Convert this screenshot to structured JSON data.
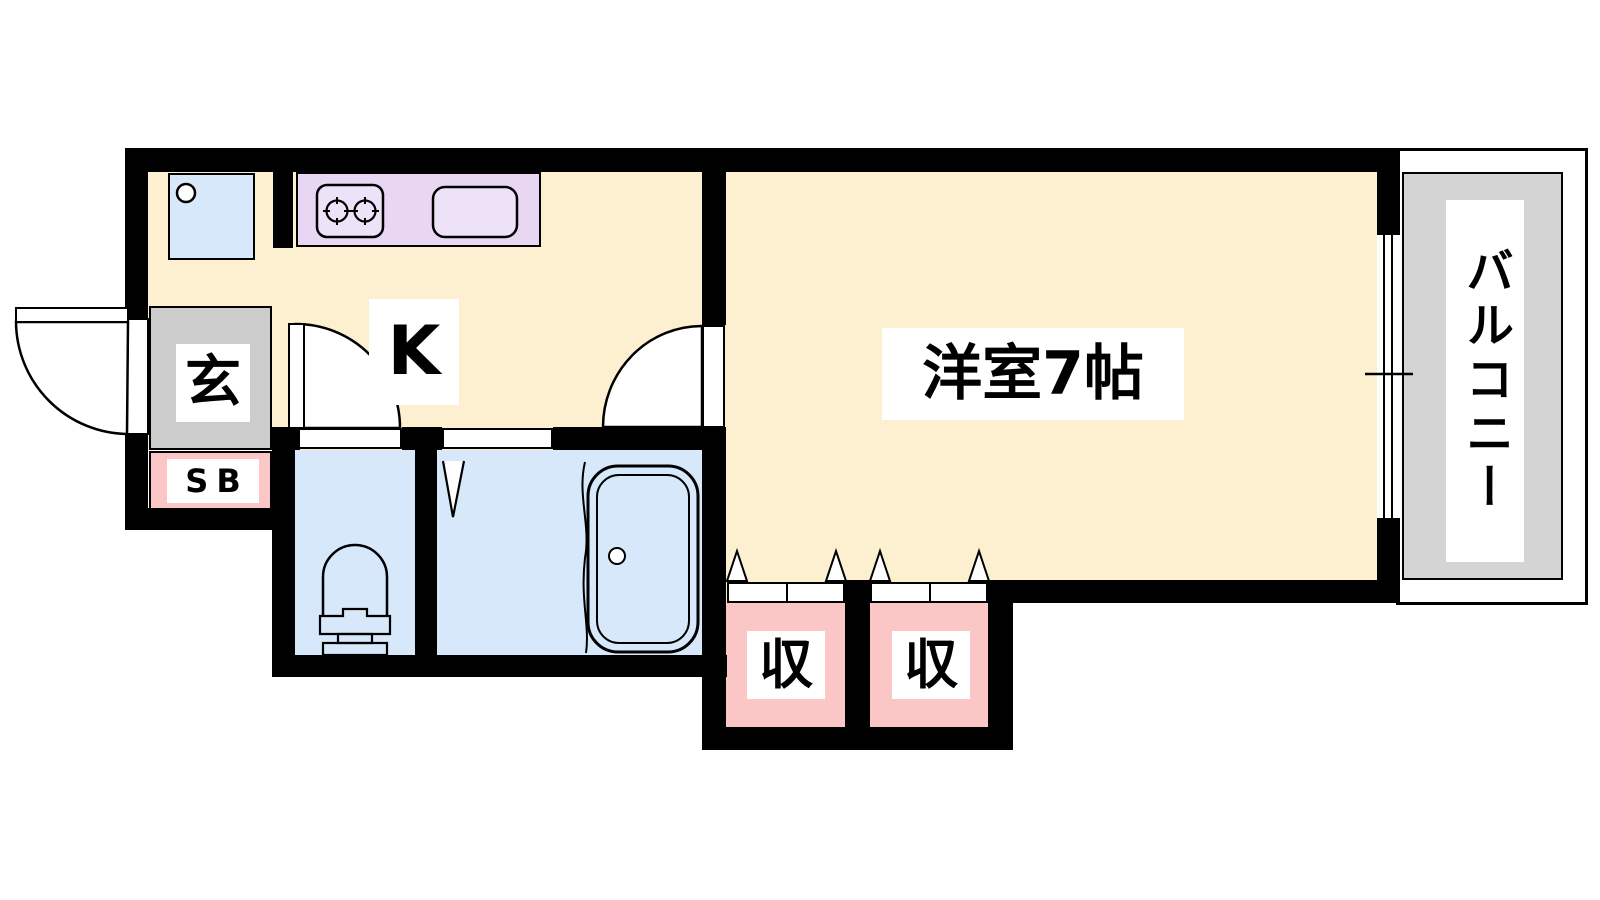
{
  "plan_type": "apartment-floor-plan",
  "labels": {
    "kitchen": "K",
    "entrance": "玄",
    "shoe_box": "SB",
    "main_room": "洋室7帖",
    "storage_left": "収",
    "storage_right": "収",
    "balcony": "バルコニー"
  },
  "rooms": [
    {
      "name": "kitchen",
      "label": "K"
    },
    {
      "name": "western-room",
      "label": "洋室7帖",
      "size_tatami": 7
    },
    {
      "name": "entrance",
      "label": "玄"
    },
    {
      "name": "shoe-box",
      "label": "SB"
    },
    {
      "name": "toilet",
      "label": ""
    },
    {
      "name": "bathroom",
      "label": ""
    },
    {
      "name": "storage-closet-1",
      "label": "収"
    },
    {
      "name": "storage-closet-2",
      "label": "収"
    },
    {
      "name": "balcony",
      "label": "バルコニー"
    }
  ],
  "colors": {
    "wall": "#000000",
    "floor": "#fcf0d0",
    "wet": "#d6e8fa",
    "closet": "#fac6c6",
    "genkan": "#cccccc",
    "counter": "#e8d6f2",
    "fixture": "#eee2f8",
    "balcony": "#d4d4d4"
  }
}
